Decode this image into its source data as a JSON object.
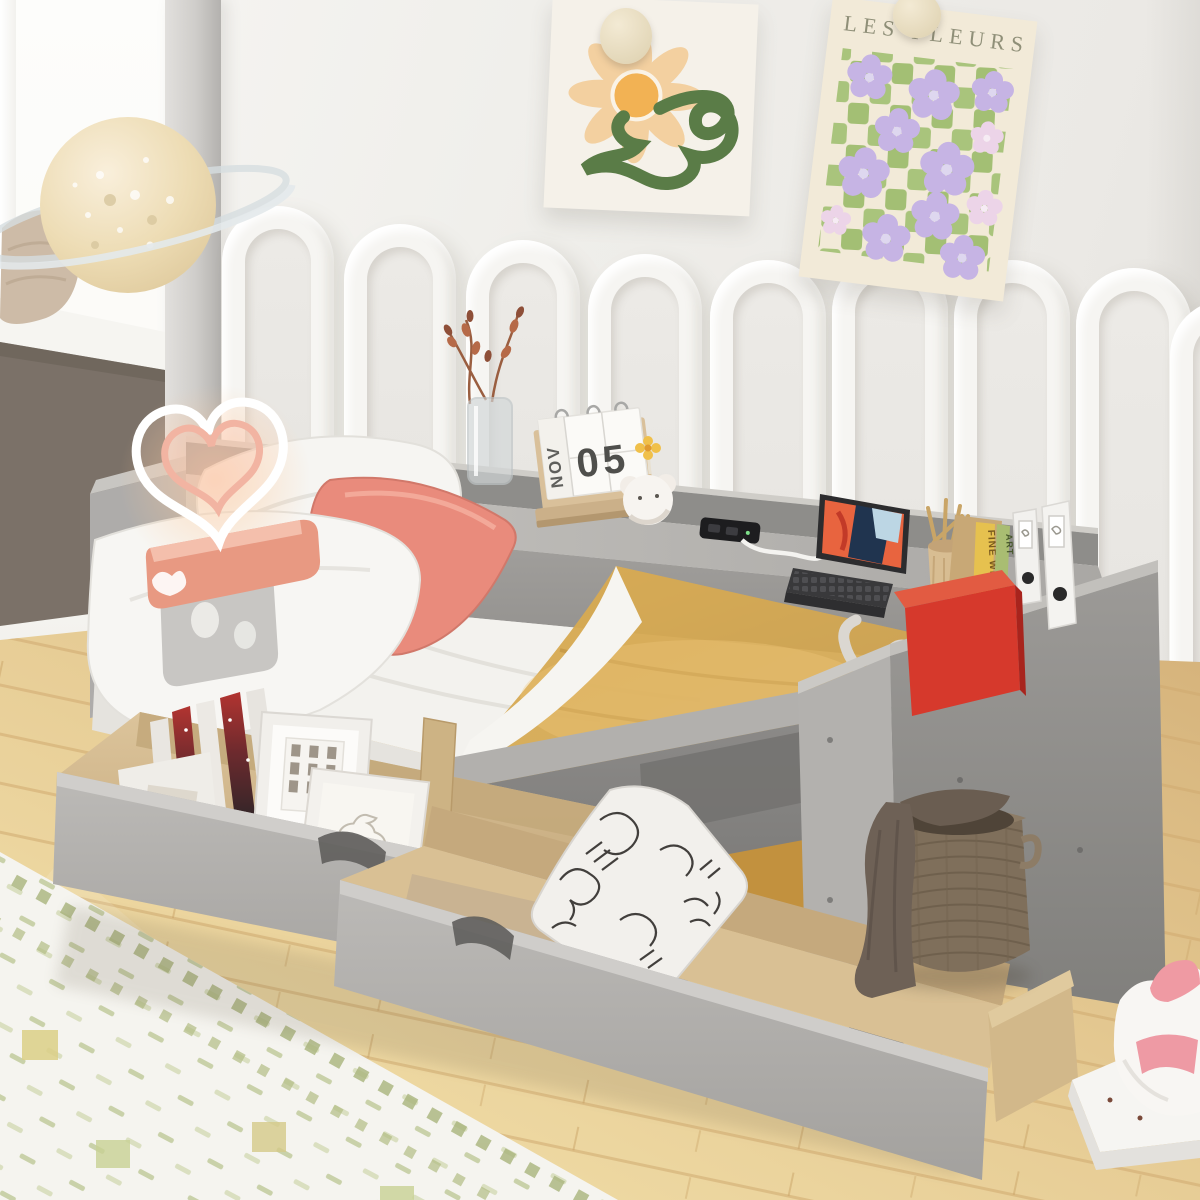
{
  "posters": {
    "les_fleurs_title": "LES FLEURS"
  },
  "calendar": {
    "month": "NOV",
    "day": "05"
  },
  "books": {
    "yellow_spine": "FINE WINE",
    "green_spine": "ART",
    "stacked_book": "MANOLO BLAHNIK"
  },
  "palette": {
    "wall": "#efeeea",
    "dark_nook_wall": "#7b7168",
    "bed_gray": "#a5a3a0",
    "blanket_mustard": "#d4a74f",
    "pillow_coral": "#e98b7c",
    "red_box": "#d6392c",
    "poster_green": "#a9c47c",
    "poster_lilac": "#c6b4e4",
    "floor_wood": "#e7cd96",
    "rug_cream": "#f5f4ef",
    "basket_brown": "#7f6f5b"
  }
}
